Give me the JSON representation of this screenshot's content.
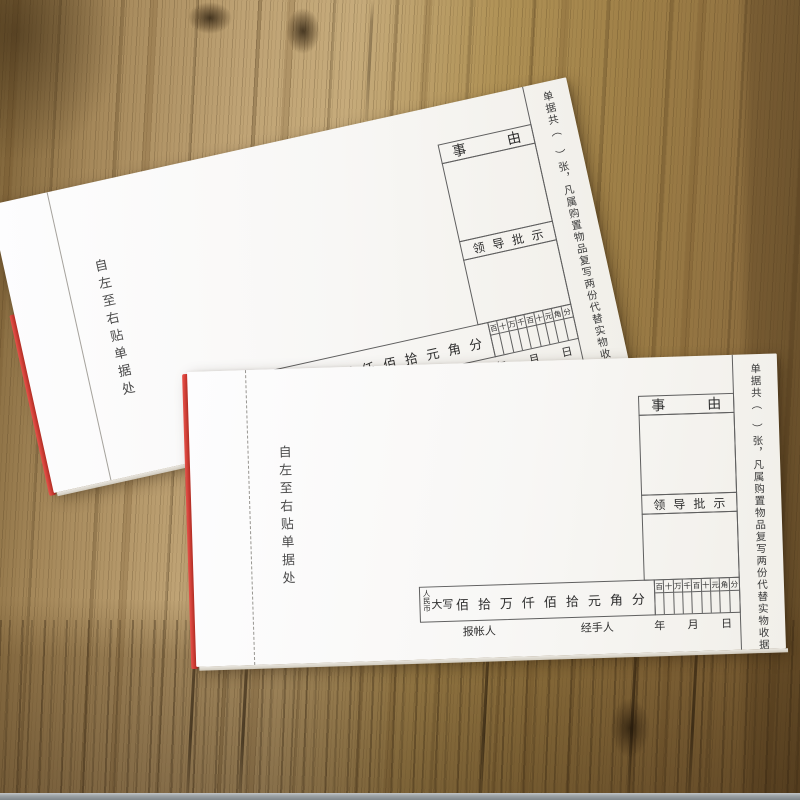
{
  "scene": {
    "background": "wood-table",
    "colors": {
      "wood_light": "#c6ab7b",
      "wood_dark": "#6f5530",
      "pad_red_edge": "#d93a32",
      "table_edge_strip": "#9aa0a3",
      "paper": "#f9f8f6",
      "form_lines": "#5f5f5f"
    }
  },
  "form": {
    "paste_note": "自左至右贴单据处",
    "side_note": "单据共（　）张，凡属购置物品复写两份代替实物收据",
    "reason_label": "事　　　由",
    "approval_label": "领导批示",
    "currency_small": "人民币",
    "currency_big": "大写",
    "amount_chars": "佰拾万仟佰拾元角分",
    "digit_cols": [
      "百",
      "十",
      "万",
      "千",
      "百",
      "十",
      "元",
      "角",
      "分"
    ],
    "payer_label": "报帐人",
    "handler_label": "经手人",
    "year_label": "年",
    "month_label": "月",
    "day_label": "日"
  }
}
